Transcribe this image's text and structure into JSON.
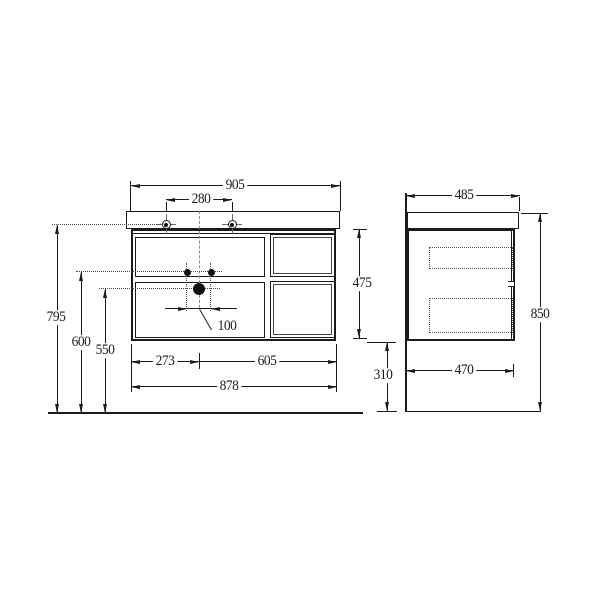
{
  "front_view": {
    "dims": {
      "overall_width": "905",
      "tap_hole_spacing": "280",
      "floor_to_tap_holes": "795",
      "floor_to_fixing_holes": "600",
      "floor_to_drain": "550",
      "fixing_hole_spacing": "100",
      "left_section_width": "273",
      "right_section_width": "605",
      "cabinet_width": "878",
      "cabinet_height": "475"
    }
  },
  "side_view": {
    "dims": {
      "overall_depth": "485",
      "cabinet_depth": "470",
      "overall_height": "850",
      "underside_clearance": "310"
    }
  }
}
